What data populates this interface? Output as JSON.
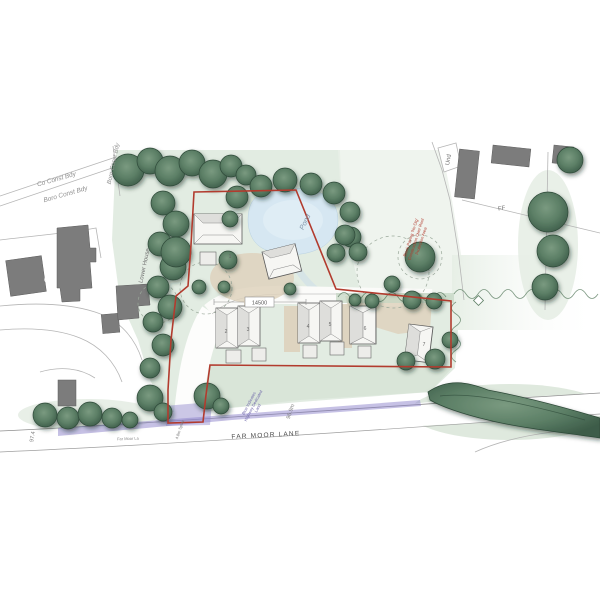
{
  "plan": {
    "boundaries": {
      "co_const": "Co Const Bdy",
      "boro_const": "Boro Const Bdy",
      "boro_const_vertical": "Boro Const Bdy"
    },
    "places": {
      "lower_house": "Lower House",
      "existing_house_number": "6",
      "und": "Und",
      "ff": "FF",
      "pond": "Pond"
    },
    "road": {
      "name": "FAR MOOR LANE",
      "name_small": "Far Moor La",
      "level_right": "96.9m",
      "level_left": "97.4",
      "splay": "4.8m Splay"
    },
    "dimension": "14500",
    "plots": [
      "1",
      "2",
      "3",
      "4",
      "5",
      "6",
      "7"
    ],
    "notes": {
      "highway_l1": "Blue Indicates",
      "highway_l2": "Highway Dedicated",
      "highway_l3": "Land",
      "root_l1": "Block Paving 'No-Dig'",
      "root_l2": "Construction Over Root",
      "root_l3": "Protection Area"
    },
    "colors": {
      "boundary_red": "#b23b2e",
      "highway_blue": "#8d84cb",
      "tree_green": "#4f7058",
      "site_wash": "#e0eadf",
      "pond_blue": "#d6e7f2",
      "building_gray": "#7c7c7c",
      "surface_beige": "#ded2bd"
    }
  }
}
